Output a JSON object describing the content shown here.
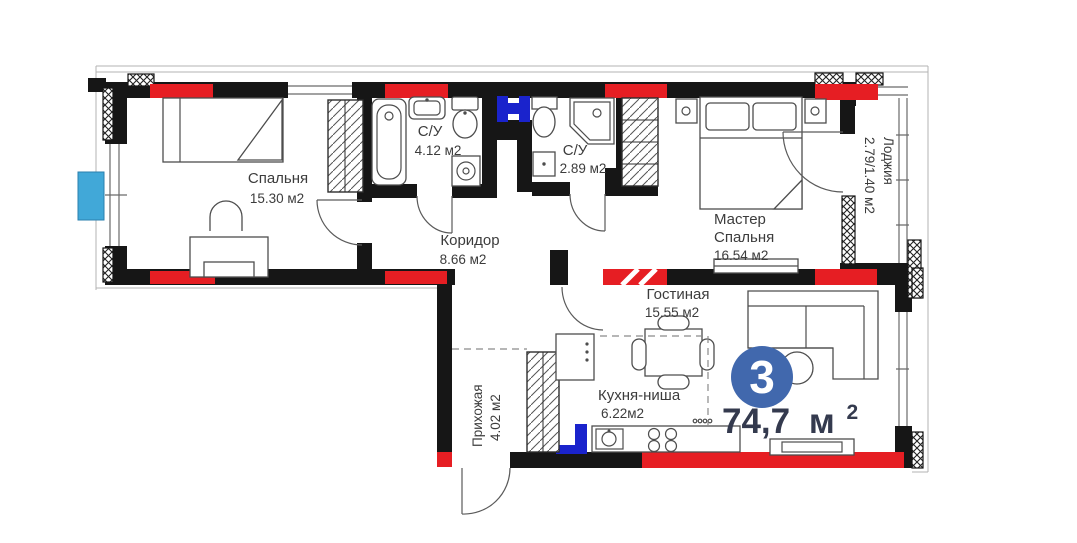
{
  "apartment": {
    "badge_number": "3",
    "total_area_value": "74,7",
    "total_area_unit": "м",
    "total_area_exponent": "2"
  },
  "rooms": {
    "bedroom": {
      "name": "Спальня",
      "area": "15.30 м2"
    },
    "bathroom_1": {
      "name": "С/У",
      "area": "4.12 м2"
    },
    "bathroom_2": {
      "name": "С/У",
      "area": "2.89 м2"
    },
    "corridor": {
      "name": "Коридор",
      "area": "8.66 м2"
    },
    "master_bedroom": {
      "name_line1": "Мастер",
      "name_line2": "Спальня",
      "area": "16.54 м2"
    },
    "loggia": {
      "name": "Лоджия",
      "area": "2.79/1.40 м2"
    },
    "living_room": {
      "name": "Гостиная",
      "area": "15.55 м2"
    },
    "kitchen_niche": {
      "name": "Кухня-ниша",
      "area": "6.22м2"
    },
    "hallway": {
      "name": "Прихожая",
      "area": "4.02 м2"
    }
  },
  "colors": {
    "radiator": "#e61e23",
    "plumbing": "#1a23cc",
    "ac_unit": "#41a8d8",
    "badge": "#4168ad",
    "area_text": "#343a4e",
    "label_text": "#3c3c3c"
  }
}
